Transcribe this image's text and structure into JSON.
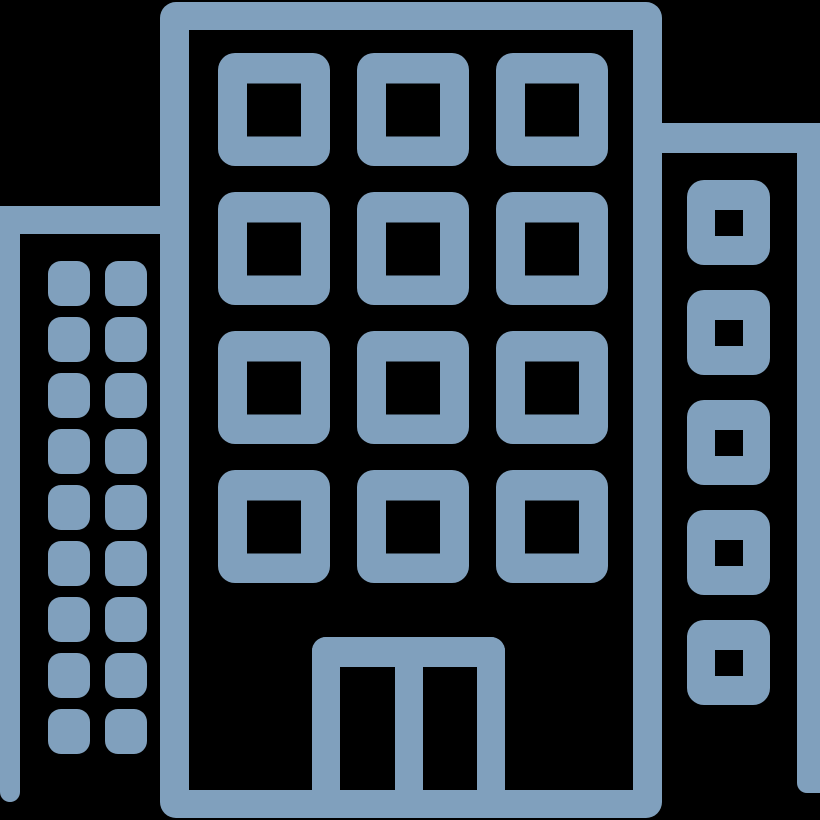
{
  "meta": {
    "description": "City buildings pictogram: three high-rise buildings drawn as a thick-stroke outline icon",
    "background_color": "#000000",
    "icon_color": "#80a0bd"
  },
  "icon": {
    "name": "buildings-icon",
    "buildings": {
      "left": {
        "label": "left tower",
        "window_rows": 9,
        "window_cols": 2,
        "window_style": "solid-rounded-square"
      },
      "center": {
        "label": "center building",
        "window_rows": 4,
        "window_cols": 3,
        "window_style": "outlined-square-with-black-center",
        "has_double_door": true
      },
      "right": {
        "label": "right tower",
        "window_rows": 5,
        "window_cols": 1,
        "window_style": "outlined-square-with-small-black-center"
      }
    }
  }
}
